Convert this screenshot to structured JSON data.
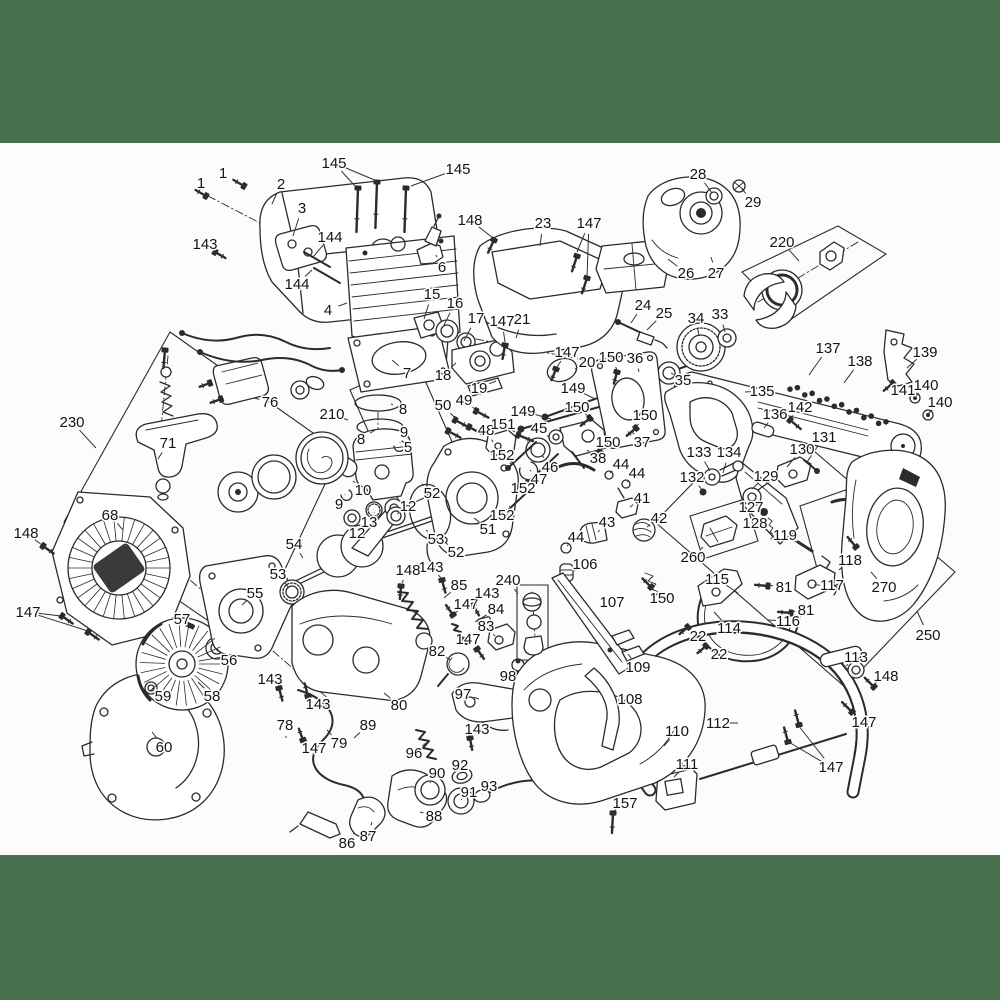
{
  "page": {
    "colors": {
      "band": "#46704E",
      "paper": "#FCFCFA",
      "ink": "#2B2B2B",
      "label_ink": "#141414"
    },
    "band_top_height": 143,
    "content_bottom": 855
  },
  "diagram": {
    "labels": [
      [
        "1",
        223,
        173,
        244,
        186
      ],
      [
        "1",
        201,
        183,
        207,
        196
      ],
      [
        "2",
        281,
        184,
        272,
        204
      ],
      [
        "3",
        302,
        208,
        293,
        236
      ],
      [
        "143",
        205,
        244,
        215,
        252
      ],
      [
        "144",
        330,
        237,
        313,
        257
      ],
      [
        "144",
        297,
        284,
        312,
        270
      ],
      [
        "4",
        328,
        310,
        347,
        303
      ],
      [
        "145",
        334,
        163,
        355,
        186
      ],
      [
        "145",
        458,
        169,
        411,
        186
      ],
      [
        "148",
        470,
        220,
        493,
        238
      ],
      [
        "6",
        442,
        267,
        436,
        255
      ],
      [
        "15",
        432,
        294,
        424,
        319
      ],
      [
        "16",
        455,
        303,
        443,
        327
      ],
      [
        "17",
        476,
        318,
        464,
        341
      ],
      [
        "7",
        407,
        373,
        392,
        360
      ],
      [
        "18",
        443,
        375,
        456,
        363
      ],
      [
        "23",
        543,
        223,
        540,
        246
      ],
      [
        "147",
        589,
        223,
        577,
        252
      ],
      [
        "28",
        698,
        174,
        712,
        193
      ],
      [
        "29",
        753,
        202,
        742,
        189
      ],
      [
        "220",
        782,
        242,
        799,
        261
      ],
      [
        "26",
        686,
        273,
        668,
        259
      ],
      [
        "27",
        716,
        273,
        711,
        257
      ],
      [
        "24",
        643,
        305,
        631,
        323
      ],
      [
        "25",
        664,
        313,
        647,
        330
      ],
      [
        "34",
        696,
        318,
        699,
        336
      ],
      [
        "33",
        720,
        314,
        725,
        332
      ],
      [
        "35",
        683,
        380,
        671,
        373
      ],
      [
        "36",
        635,
        358,
        639,
        372
      ],
      [
        "150",
        611,
        357,
        617,
        370
      ],
      [
        "20",
        587,
        362,
        575,
        369
      ],
      [
        "147",
        567,
        352,
        557,
        367
      ],
      [
        "21",
        522,
        319,
        516,
        338
      ],
      [
        "147",
        502,
        321,
        505,
        342
      ],
      [
        "19",
        479,
        388,
        496,
        381
      ],
      [
        "149",
        573,
        388,
        595,
        399
      ],
      [
        "149",
        523,
        411,
        551,
        419
      ],
      [
        "137",
        828,
        348,
        809,
        375
      ],
      [
        "138",
        860,
        361,
        844,
        383
      ],
      [
        "139",
        925,
        352,
        907,
        368
      ],
      [
        "141",
        903,
        390,
        894,
        384
      ],
      [
        "140",
        926,
        385,
        915,
        397
      ],
      [
        "140",
        940,
        402,
        928,
        414
      ],
      [
        "135",
        762,
        391,
        745,
        392
      ],
      [
        "142",
        800,
        407,
        790,
        419
      ],
      [
        "136",
        775,
        414,
        764,
        428
      ],
      [
        "131",
        824,
        437,
        807,
        462
      ],
      [
        "130",
        802,
        449,
        787,
        467
      ],
      [
        "129",
        766,
        476,
        752,
        489
      ],
      [
        "133",
        699,
        452,
        710,
        471
      ],
      [
        "134",
        729,
        452,
        723,
        473
      ],
      [
        "132",
        692,
        477,
        702,
        490
      ],
      [
        "127",
        751,
        507,
        762,
        511
      ],
      [
        "128",
        755,
        523,
        766,
        526
      ],
      [
        "119",
        785,
        535,
        798,
        543
      ],
      [
        "118",
        850,
        560,
        839,
        570
      ],
      [
        "117",
        832,
        585,
        814,
        585
      ],
      [
        "115",
        717,
        579,
        738,
        593
      ],
      [
        "81",
        784,
        587,
        767,
        585
      ],
      [
        "81",
        806,
        610,
        790,
        612
      ],
      [
        "116",
        788,
        621,
        767,
        620
      ],
      [
        "114",
        729,
        628,
        714,
        612
      ],
      [
        "22",
        698,
        636,
        690,
        627
      ],
      [
        "22",
        719,
        654,
        707,
        646
      ],
      [
        "260",
        693,
        557,
        703,
        547
      ],
      [
        "270",
        884,
        587,
        871,
        572
      ],
      [
        "250",
        928,
        635,
        917,
        611
      ],
      [
        "113",
        856,
        657,
        846,
        666
      ],
      [
        "148",
        886,
        676,
        873,
        685
      ],
      [
        "112",
        718,
        723,
        738,
        723
      ],
      [
        "147",
        864,
        722,
        852,
        712
      ],
      [
        "147",
        831,
        767,
        798,
        725
      ],
      [
        "110",
        677,
        731,
        664,
        746
      ],
      [
        "111",
        687,
        764,
        674,
        777
      ],
      [
        "157",
        625,
        803,
        614,
        811
      ],
      [
        "230",
        72,
        422,
        96,
        448
      ],
      [
        "76",
        270,
        402,
        254,
        398
      ],
      [
        "210",
        332,
        414,
        348,
        420
      ],
      [
        "71",
        168,
        443,
        158,
        459
      ],
      [
        "68",
        110,
        515,
        123,
        530
      ],
      [
        "148",
        26,
        533,
        42,
        545
      ],
      [
        "147",
        28,
        612,
        61,
        616
      ],
      [
        "8",
        403,
        409,
        391,
        404
      ],
      [
        "8",
        361,
        439,
        375,
        430
      ],
      [
        "9",
        404,
        432,
        400,
        443
      ],
      [
        "5",
        408,
        447,
        402,
        455
      ],
      [
        "10",
        363,
        490,
        353,
        481
      ],
      [
        "9",
        339,
        504,
        345,
        494
      ],
      [
        "12",
        408,
        506,
        397,
        514
      ],
      [
        "13",
        369,
        522,
        374,
        513
      ],
      [
        "12",
        357,
        533,
        353,
        522
      ],
      [
        "54",
        294,
        544,
        303,
        558
      ],
      [
        "53",
        278,
        574,
        289,
        588
      ],
      [
        "55",
        255,
        593,
        242,
        605
      ],
      [
        "57",
        182,
        619,
        190,
        626
      ],
      [
        "56",
        229,
        660,
        217,
        649
      ],
      [
        "59",
        163,
        696,
        152,
        688
      ],
      [
        "58",
        212,
        696,
        198,
        682
      ],
      [
        "143",
        270,
        679,
        278,
        687
      ],
      [
        "143",
        318,
        704,
        309,
        696
      ],
      [
        "60",
        164,
        747,
        152,
        732
      ],
      [
        "78",
        285,
        725,
        286,
        738
      ],
      [
        "147",
        314,
        748,
        304,
        739
      ],
      [
        "79",
        339,
        743,
        327,
        730
      ],
      [
        "89",
        368,
        725,
        354,
        738
      ],
      [
        "86",
        347,
        843,
        354,
        833
      ],
      [
        "87",
        368,
        836,
        372,
        822
      ],
      [
        "88",
        434,
        816,
        420,
        812
      ],
      [
        "90",
        437,
        773,
        430,
        783
      ],
      [
        "92",
        460,
        765,
        457,
        776
      ],
      [
        "91",
        469,
        792,
        462,
        799
      ],
      [
        "93",
        489,
        786,
        482,
        794
      ],
      [
        "96",
        414,
        753,
        426,
        743
      ],
      [
        "143",
        477,
        729,
        470,
        737
      ],
      [
        "97",
        463,
        694,
        479,
        699
      ],
      [
        "98",
        508,
        676,
        516,
        669
      ],
      [
        "80",
        399,
        705,
        384,
        693
      ],
      [
        "82",
        437,
        651,
        450,
        660
      ],
      [
        "83",
        486,
        626,
        495,
        636
      ],
      [
        "147",
        468,
        639,
        476,
        648
      ],
      [
        "84",
        496,
        609,
        475,
        622
      ],
      [
        "147",
        466,
        604,
        454,
        614
      ],
      [
        "143",
        487,
        593,
        475,
        603
      ],
      [
        "85",
        459,
        585,
        444,
        598
      ],
      [
        "143",
        431,
        567,
        441,
        578
      ],
      [
        "148",
        408,
        570,
        402,
        583
      ],
      [
        "240",
        508,
        580,
        518,
        594
      ],
      [
        "106",
        585,
        564,
        574,
        571
      ],
      [
        "107",
        612,
        602,
        602,
        607
      ],
      [
        "108",
        630,
        699,
        618,
        700
      ],
      [
        "109",
        638,
        667,
        628,
        654
      ],
      [
        "150",
        662,
        598,
        652,
        588
      ],
      [
        "50",
        443,
        405,
        455,
        418
      ],
      [
        "49",
        464,
        400,
        476,
        410
      ],
      [
        "48",
        486,
        430,
        493,
        442
      ],
      [
        "151",
        503,
        424,
        515,
        432
      ],
      [
        "45",
        539,
        428,
        550,
        438
      ],
      [
        "150",
        577,
        407,
        588,
        416
      ],
      [
        "150",
        645,
        415,
        637,
        426
      ],
      [
        "150",
        608,
        442,
        600,
        450
      ],
      [
        "37",
        642,
        442,
        632,
        432
      ],
      [
        "38",
        598,
        458,
        587,
        450
      ],
      [
        "46",
        550,
        467,
        542,
        455
      ],
      [
        "47",
        539,
        479,
        530,
        470
      ],
      [
        "152",
        502,
        455,
        511,
        464
      ],
      [
        "152",
        523,
        488,
        529,
        480
      ],
      [
        "152",
        502,
        515,
        510,
        506
      ],
      [
        "51",
        488,
        529,
        474,
        518
      ],
      [
        "52",
        432,
        493,
        422,
        484
      ],
      [
        "53",
        436,
        539,
        426,
        530
      ],
      [
        "52",
        456,
        552,
        446,
        543
      ],
      [
        "44",
        621,
        464,
        610,
        473
      ],
      [
        "44",
        637,
        473,
        627,
        482
      ],
      [
        "41",
        642,
        498,
        630,
        507
      ],
      [
        "42",
        659,
        518,
        647,
        527
      ],
      [
        "43",
        607,
        522,
        598,
        532
      ],
      [
        "44",
        576,
        537,
        567,
        546
      ]
    ],
    "extra_leaders": [
      [
        334,
        163,
        377,
        181
      ],
      [
        589,
        223,
        587,
        277
      ],
      [
        28,
        612,
        88,
        631
      ],
      [
        831,
        767,
        787,
        741
      ]
    ]
  }
}
